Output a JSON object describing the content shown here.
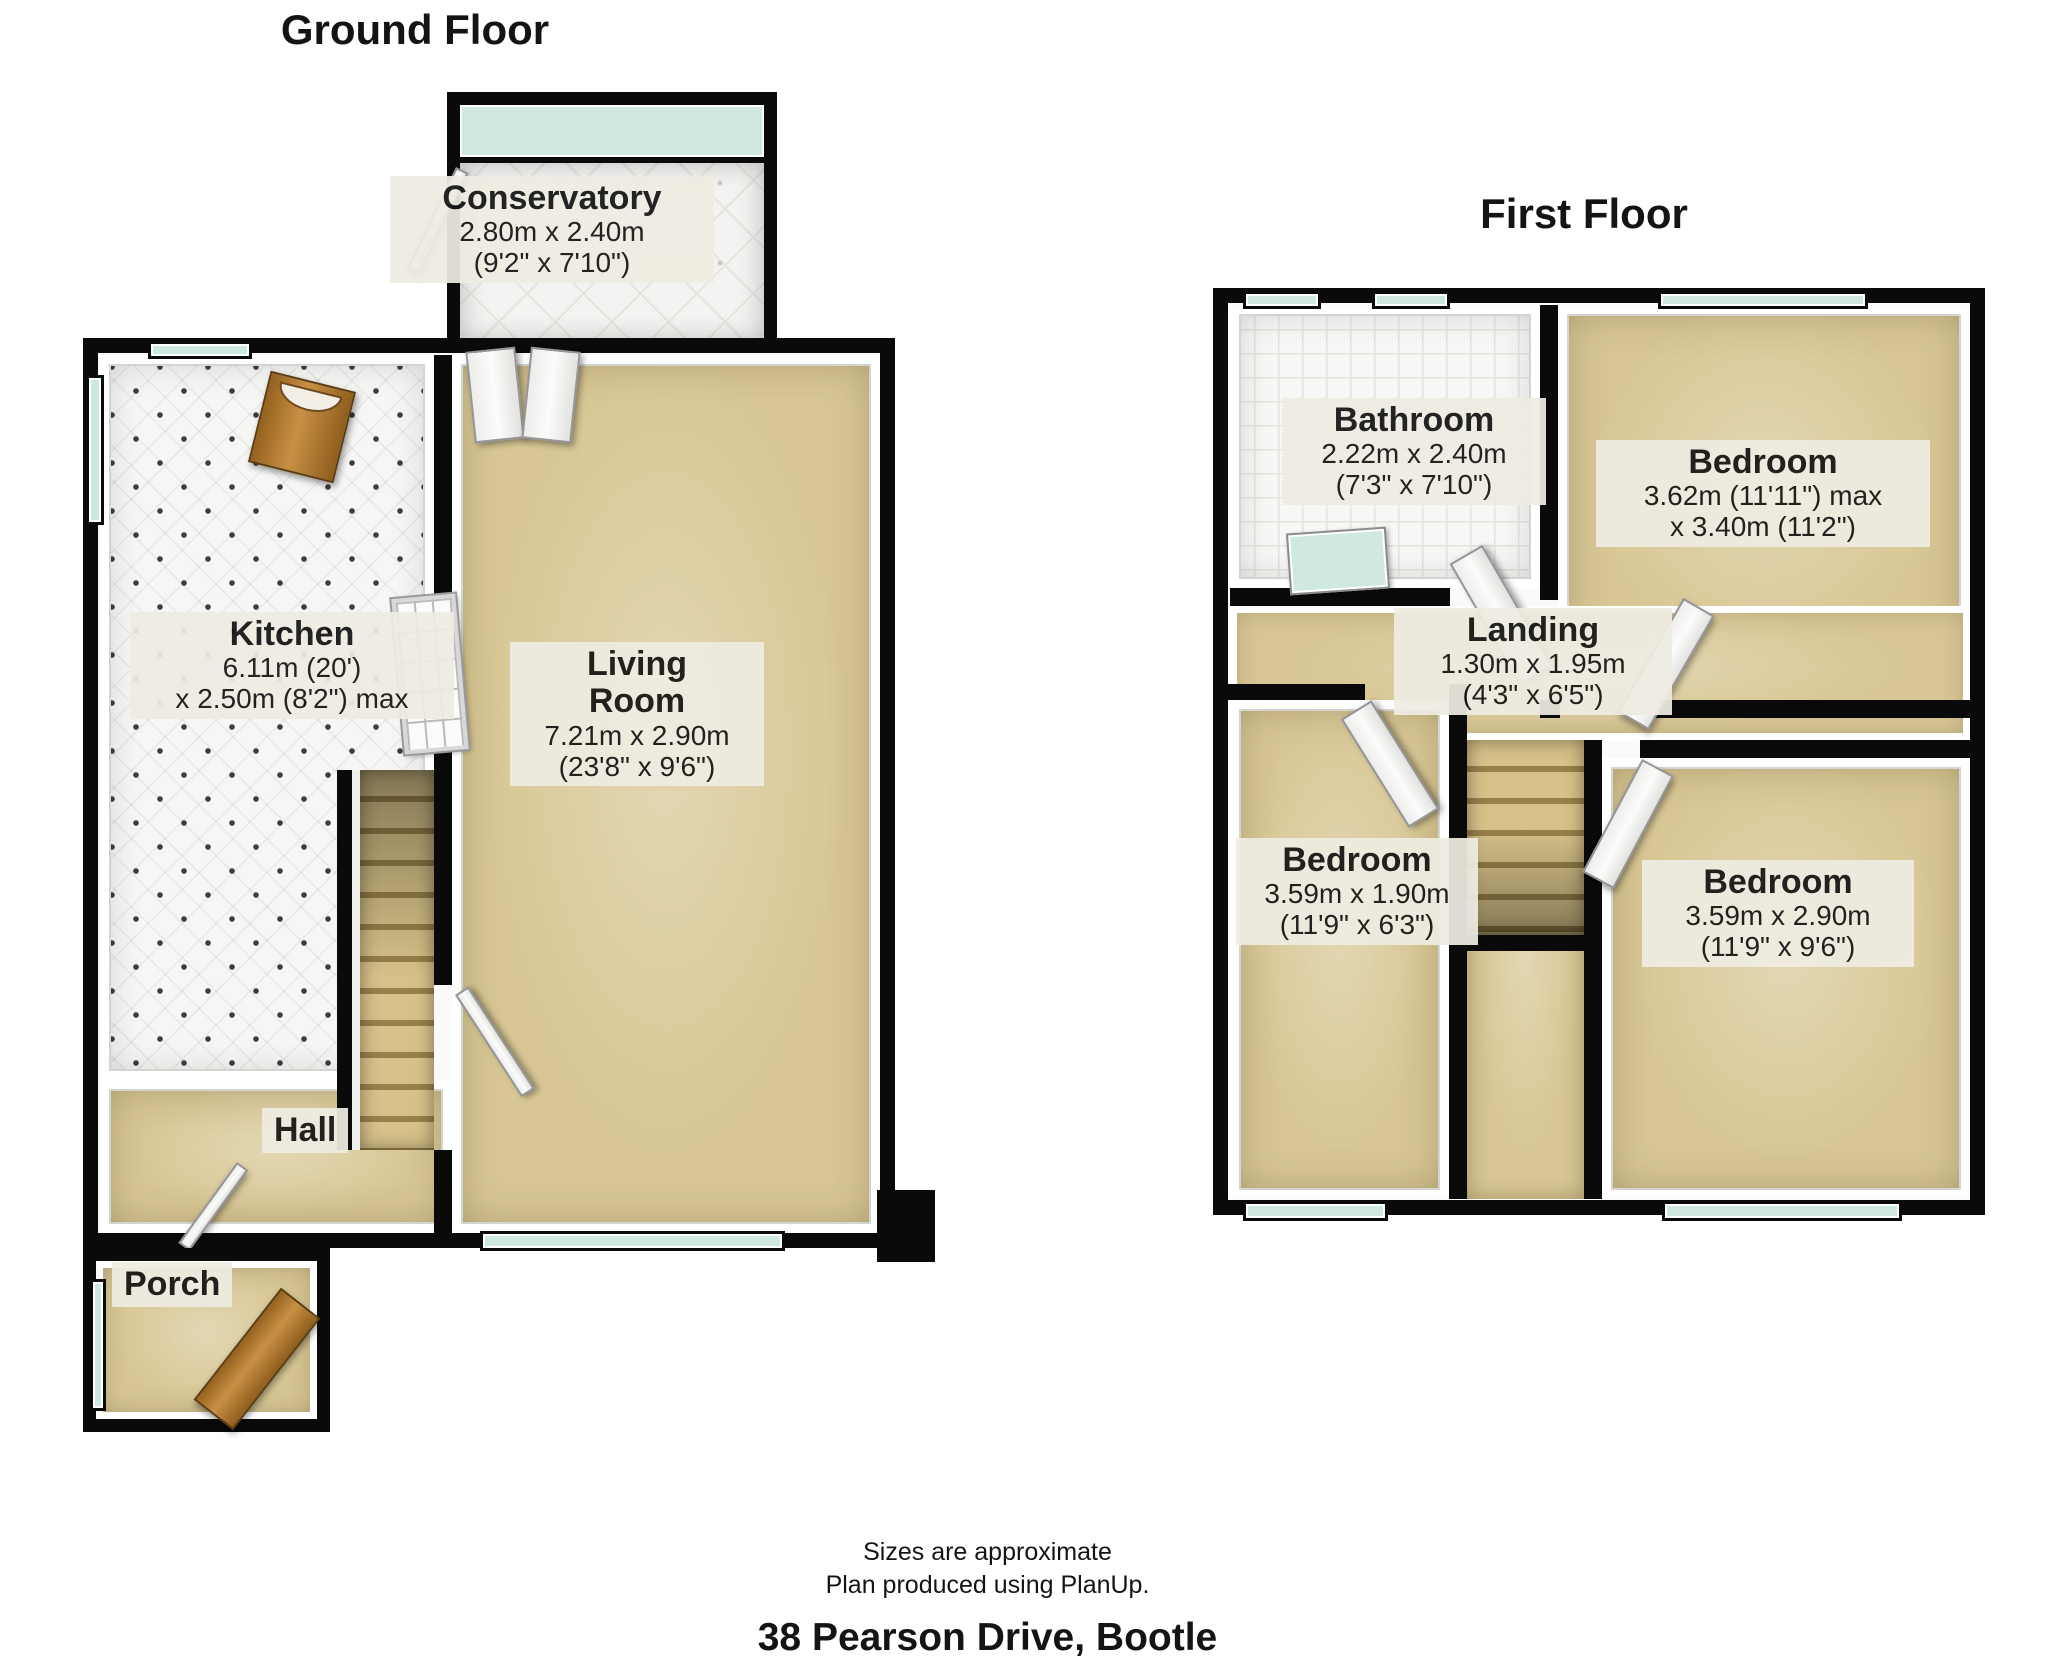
{
  "colors": {
    "wall": "#0a0a0a",
    "carpet": "#d8c795",
    "glass": "#cfe9e2",
    "tile": "#f6f6f4",
    "wood_door": "#b07c3c",
    "label_bg": "#efece2",
    "text": "#141414",
    "background": "#ffffff"
  },
  "ground_floor": {
    "title": "Ground Floor",
    "rooms": {
      "conservatory": {
        "name": "Conservatory",
        "dim1": "2.80m x 2.40m",
        "dim2": "(9'2\" x 7'10\")"
      },
      "kitchen": {
        "name": "Kitchen",
        "dim1": "6.11m (20')",
        "dim2": "x 2.50m (8'2\") max"
      },
      "living_room": {
        "name": "Living\nRoom",
        "dim1": "7.21m x 2.90m",
        "dim2": "(23'8\" x 9'6\")"
      },
      "hall": {
        "name": "Hall"
      },
      "porch": {
        "name": "Porch"
      }
    }
  },
  "first_floor": {
    "title": "First Floor",
    "rooms": {
      "bathroom": {
        "name": "Bathroom",
        "dim1": "2.22m x 2.40m",
        "dim2": "(7'3\" x 7'10\")"
      },
      "bedroom_rear": {
        "name": "Bedroom",
        "dim1": "3.62m (11'11\") max",
        "dim2": "x 3.40m (11'2\")"
      },
      "landing": {
        "name": "Landing",
        "dim1": "1.30m x 1.95m",
        "dim2": "(4'3\" x 6'5\")"
      },
      "bedroom_front_left": {
        "name": "Bedroom",
        "dim1": "3.59m x 1.90m",
        "dim2": "(11'9\" x 6'3\")"
      },
      "bedroom_front_right": {
        "name": "Bedroom",
        "dim1": "3.59m x 2.90m",
        "dim2": "(11'9\" x 9'6\")"
      }
    }
  },
  "footer": {
    "line1": "Sizes are approximate",
    "line2": "Plan produced using PlanUp.",
    "address": "38 Pearson Drive, Bootle"
  }
}
